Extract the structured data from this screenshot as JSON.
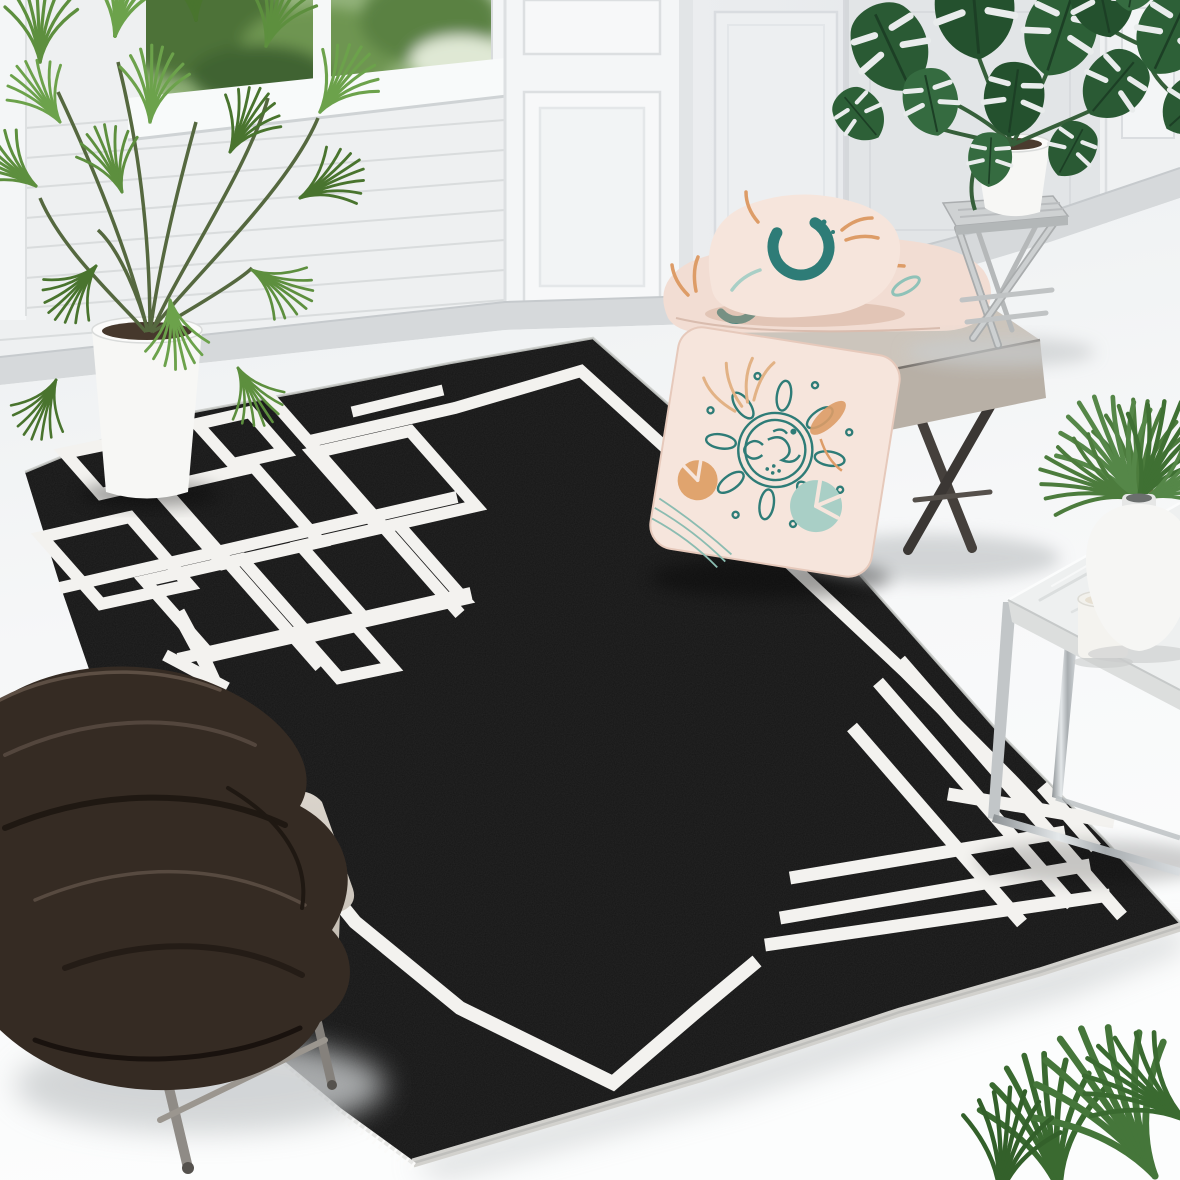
{
  "scene": {
    "domain": "natural-image",
    "description": "Product photograph of a black rectangular area rug with a white geometric border: a thin white inner border line, an interlaced geometric knot motif in the upper-left corner, crossed parallel line accents in the lower-right corner and a fringed edge, staged in a bright white living room with shiplap and panelled walls, a window with greenery, houseplants, a beige bench with blush boho cushions, a marble chrome coffee table and a grey stool with a dark brown throw blanket",
    "no_visible_text": true
  },
  "product": {
    "label": "black rug with white geometric line border",
    "motifs": [
      "white inner border line",
      "interlaced geometric knot in top-left corner",
      "grid of crossed parallel lines in bottom-right corner",
      "short dash accents beside the border",
      "white fringe on the lower-left edge",
      "light serged binding on the lower-right edge"
    ]
  },
  "objects": [
    {
      "id": "rug",
      "label": "black geometric area rug"
    },
    {
      "id": "fan-palm",
      "label": "potted fan palm in white planter"
    },
    {
      "id": "window",
      "label": "white framed window with garden greenery"
    },
    {
      "id": "monstera",
      "label": "potted monstera on weathered folding stand"
    },
    {
      "id": "monstera-corner",
      "label": "monstera leaves entering top-right corner"
    },
    {
      "id": "bench",
      "label": "beige ottoman bench with dark metal cross legs"
    },
    {
      "id": "cushions",
      "label": "three blush cushions with teal and orange boho prints"
    },
    {
      "id": "coffee-table",
      "label": "marble-top coffee table with chrome frame"
    },
    {
      "id": "vase-plant",
      "label": "white vase with areca palm"
    },
    {
      "id": "candle",
      "label": "white pillar candle"
    },
    {
      "id": "ottoman",
      "label": "grey ottoman stool"
    },
    {
      "id": "blanket",
      "label": "dark brown chunky throw blanket"
    },
    {
      "id": "corner-plant",
      "label": "palm fronds at bottom-right corner"
    }
  ],
  "colors": {
    "rug_black": "#161616",
    "rug_pattern": "#f3f2ef",
    "rug_serge": "#d2d1cd",
    "rug_fringe": "#fbfbfa",
    "floor_light": "#f3f5f6",
    "wall_left": "#eef0f1",
    "wall_right": "#e7eaec",
    "wall_alcove": "#e2e5e7",
    "wall_panel": "#edeff1",
    "baseboard": "#d6d9db",
    "pillar": "#f4f6f7",
    "window_frame": "#f8fafa",
    "pillow_blush": "#f6e5dc",
    "pillow_blush_2": "#f2ddd3",
    "motif_teal": "#2e7c77",
    "motif_teal_light": "#a9cfc6",
    "motif_orange": "#dd9c67",
    "blanket_brown": "#352b23",
    "bench_top": "#ccc5bc",
    "bench_front": "#b8b0a6",
    "bench_leg": "#45403c",
    "stool_grey": "#cfd2d3",
    "pot_white": "#f7f7f5",
    "monstera_green": "#2a5a34",
    "palm_green": "#5d8f3e",
    "marble": "#eef0f0",
    "chrome": "#c2c6c8",
    "candle_white": "#f4f3ef",
    "ottoman_beige": "#d8d2c9",
    "ottoman_leg": "#8f8b86",
    "vase_white": "#f6f6f4",
    "shadow_grey": "#c9ccce"
  }
}
